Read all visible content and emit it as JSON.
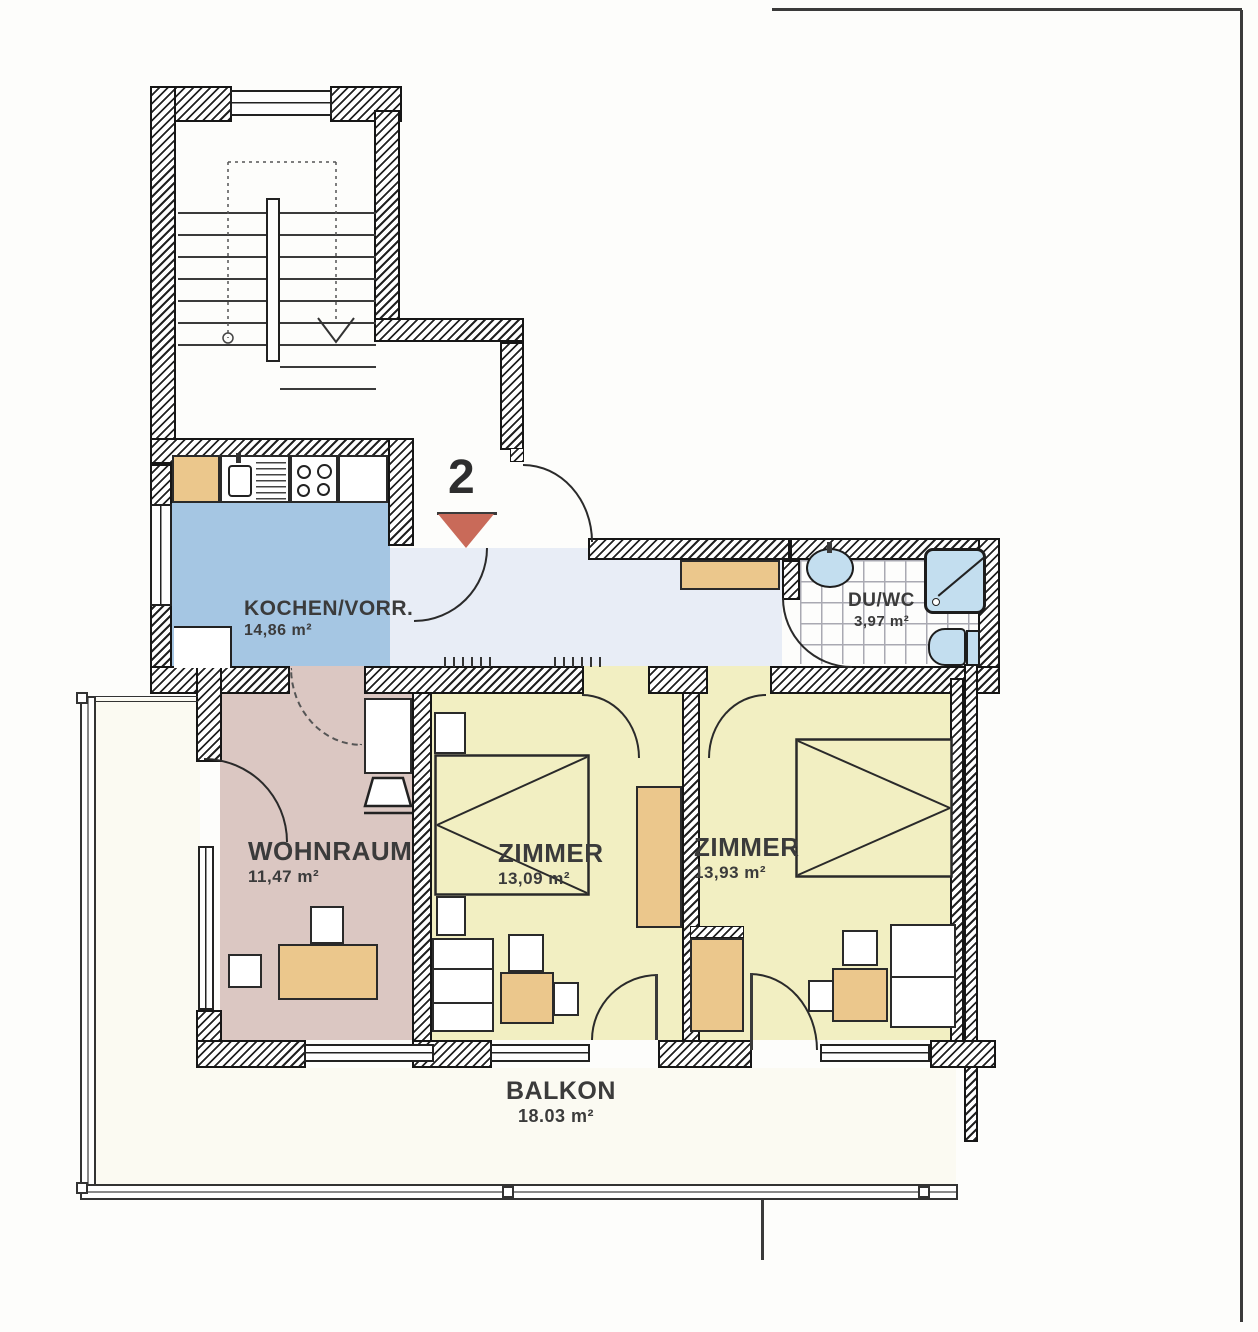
{
  "plan": {
    "unit_marker": "2",
    "rooms": [
      {
        "id": "kitchen",
        "name": "KOCHEN/VORR.",
        "area": "14,86 m²"
      },
      {
        "id": "bath",
        "name": "DU/WC",
        "area": "3,97 m²"
      },
      {
        "id": "living",
        "name": "WOHNRAUM",
        "area": "11,47 m²"
      },
      {
        "id": "room1",
        "name": "ZIMMER",
        "area": "13,09 m²"
      },
      {
        "id": "room2",
        "name": "ZIMMER",
        "area": "13,93 m²"
      },
      {
        "id": "balcony",
        "name": "BALKON",
        "area": "18.03 m²"
      }
    ],
    "colors": {
      "kitchen_floor": "#a5c6e3",
      "corridor_floor": "#e8edf6",
      "living_floor": "#dbc7c2",
      "bedroom_floor": "#f2efc2",
      "balcony_floor": "#fbfaf2",
      "furniture_wood": "#ebc78c",
      "fixture_blue": "#c3deef",
      "marker_red": "#c96a59"
    }
  }
}
